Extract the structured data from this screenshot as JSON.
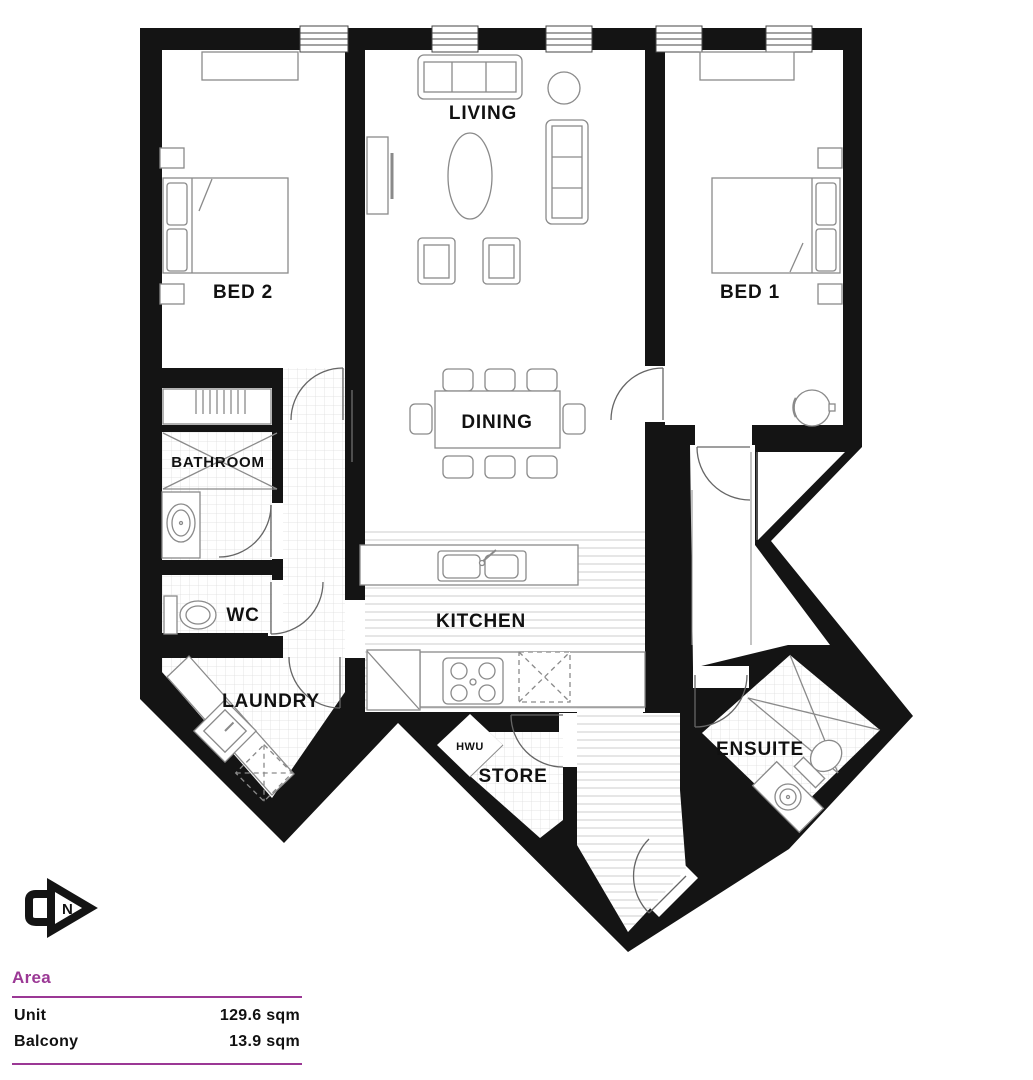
{
  "plan": {
    "rooms": {
      "living": "LIVING",
      "bed2": "BED 2",
      "bed1": "BED 1",
      "dining": "DINING",
      "bathroom": "BATHROOM",
      "wc": "WC",
      "kitchen": "KITCHEN",
      "laundry": "LAUNDRY",
      "hwu": "HWU",
      "store": "STORE",
      "ensuite": "ENSUITE"
    },
    "north_label": "N"
  },
  "area_table": {
    "heading": "Area",
    "rows": [
      {
        "label": "Unit",
        "value": "129.6 sqm"
      },
      {
        "label": "Balcony",
        "value": "13.9 sqm"
      }
    ]
  },
  "colors": {
    "accent": "#9B3895",
    "wall": "#141414"
  }
}
